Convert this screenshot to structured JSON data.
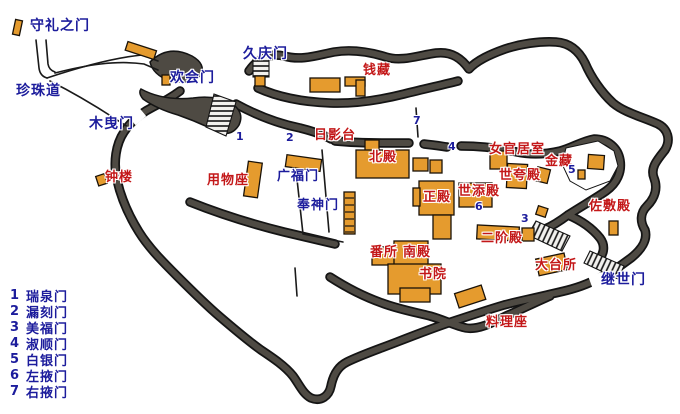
{
  "colors": {
    "wall": "#4e4a43",
    "wall_edge": "#141414",
    "building": "#e59b2e",
    "building_edge": "#1a1208",
    "gate_text": "#1c1c9c",
    "site_text": "#c31718",
    "background": "#ffffff"
  },
  "gate_labels": {
    "shurei": "守礼之门",
    "pearl_road": "珍珠道",
    "kobiki": "木曳门",
    "kankai": "欢会门",
    "kyukei": "久庆门",
    "kofuku": "广福门",
    "hoshin": "奉神门",
    "keisei": "继世门"
  },
  "site_labels": {
    "zenikura": "钱藏",
    "hikagedai": "日影台",
    "hokuden": "北殿",
    "yomotsuza": "用物座",
    "shoro": "钟楼",
    "nyokan": "女官居室",
    "kinzo": "金藏",
    "yohokoriden": "世夸殿",
    "yosoeden": "世添殿",
    "seiden": "正殿",
    "nikaiden": "二阶殿",
    "bansho": "番所",
    "nanden": "南殿",
    "shoin": "书院",
    "odaidokoro": "大台所",
    "sashikiden": "佐敷殿",
    "ryoriza": "料理座"
  },
  "map_numbers": {
    "n1": "1",
    "n2": "2",
    "n3": "3",
    "n4": "4",
    "n5": "5",
    "n6": "6",
    "n7": "7"
  },
  "legend": {
    "items": [
      {
        "num": "1",
        "name": "瑞泉门"
      },
      {
        "num": "2",
        "name": "漏刻门"
      },
      {
        "num": "3",
        "name": "美福门"
      },
      {
        "num": "4",
        "name": "淑顺门"
      },
      {
        "num": "5",
        "name": "白银门"
      },
      {
        "num": "6",
        "name": "左掖门"
      },
      {
        "num": "7",
        "name": "右掖门"
      }
    ]
  }
}
